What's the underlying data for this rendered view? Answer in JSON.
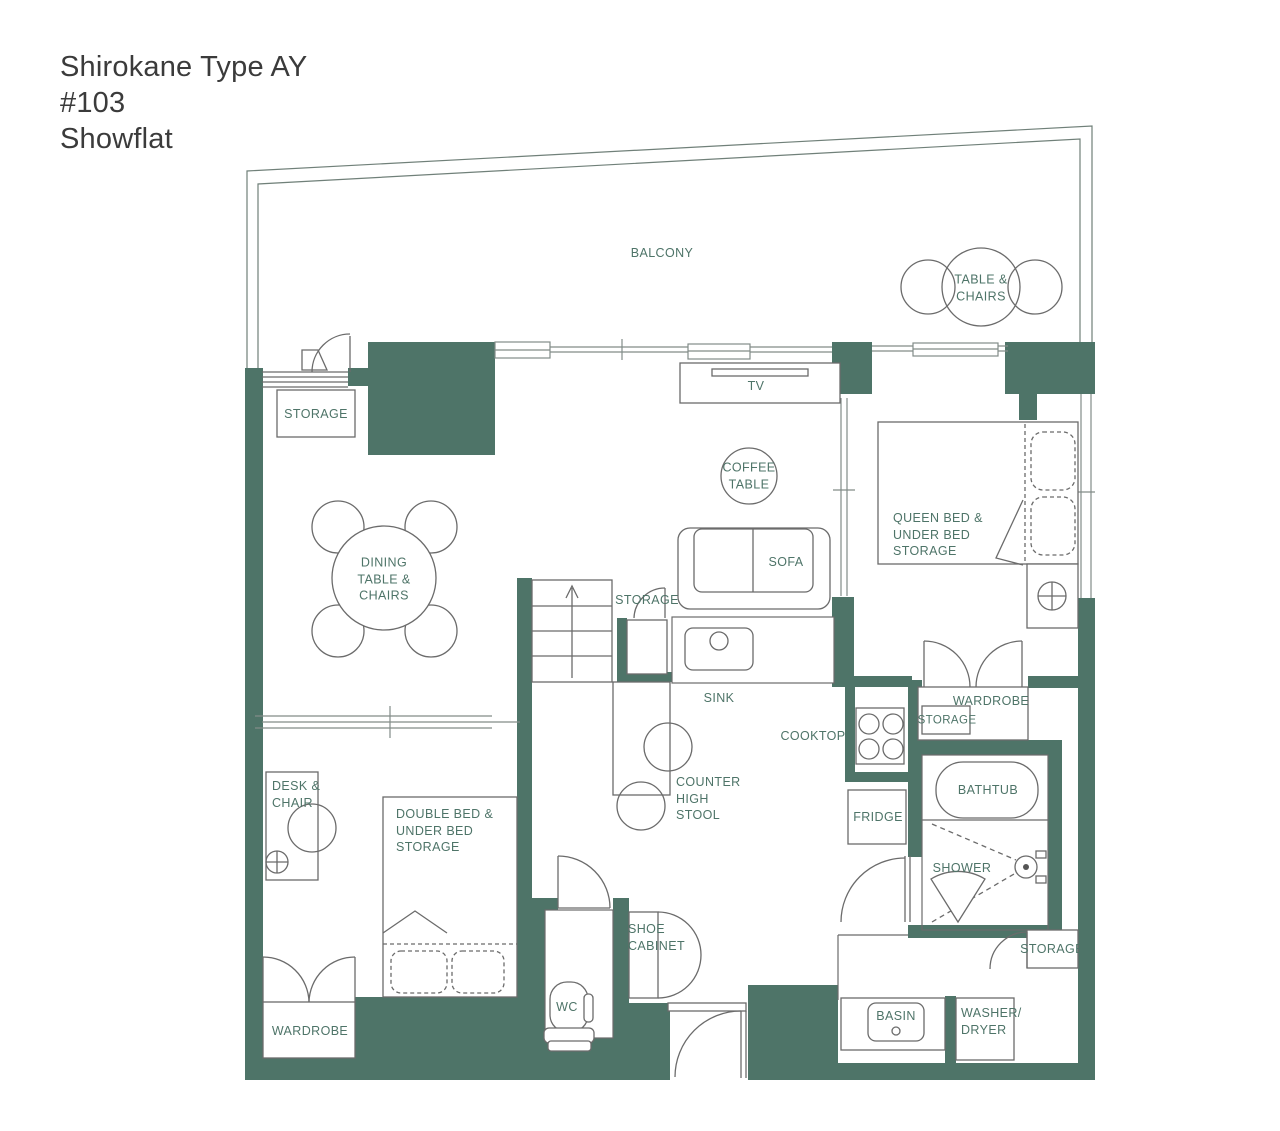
{
  "title": "Shirokane Type AY\n#103\nShowflat",
  "colors": {
    "wall": "#4e7468",
    "label": "#4e7468",
    "furniture_line": "#6b6b6b",
    "title_text": "#3b3b3b"
  },
  "labels": {
    "balcony": "BALCONY",
    "table_chairs": "TABLE &\nCHAIRS",
    "storage_top": "STORAGE",
    "tv": "TV",
    "coffee_table": "COFFEE\nTABLE",
    "queen_bed": "QUEEN BED &\nUNDER BED\nSTORAGE",
    "dining": "DINING\nTABLE &\nCHAIRS",
    "sofa": "SOFA",
    "storage_stairs": "STORAGE",
    "sink": "SINK",
    "cooktop": "COOKTOP",
    "wardrobe_right": "WARDROBE",
    "storage_wardrobe": "STORAGE",
    "counter_stool": "COUNTER\nHIGH\nSTOOL",
    "fridge": "FRIDGE",
    "bathtub": "BATHTUB",
    "shower": "SHOWER",
    "desk_chair": "DESK &\nCHAIR",
    "double_bed": "DOUBLE BED &\nUNDER BED\nSTORAGE",
    "wardrobe_left": "WARDROBE",
    "wc": "WC",
    "shoe_cabinet": "SHOE\nCABINET",
    "storage_entry": "STORAGE",
    "basin": "BASIN",
    "washer_dryer": "WASHER/\nDRYER"
  }
}
